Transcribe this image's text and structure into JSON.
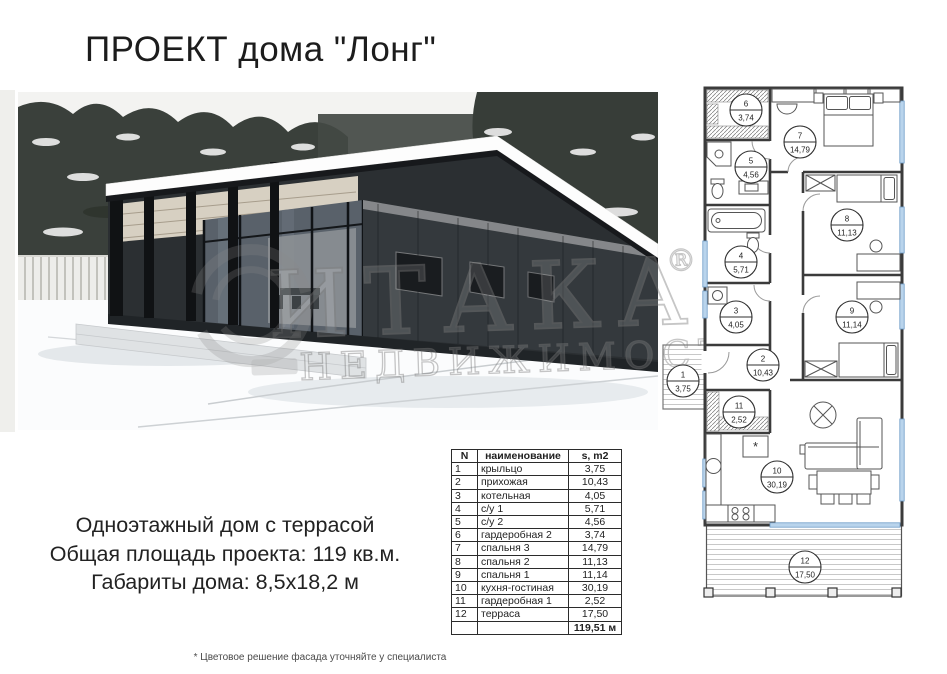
{
  "page": {
    "title": "ПРОЕКТ дома \"Лонг\"",
    "footer_note": "* Цветовое решение фасада уточняйте у специалиста"
  },
  "watermark": {
    "brand": "ИТАКА",
    "reg": "®",
    "subtitle": "НЕДВИЖИМОСТЬ"
  },
  "specs": {
    "lines": [
      "Одноэтажный дом с террасой",
      "Общая площадь проекта: 119 кв.м.",
      "Габариты дома: 8,5х18,2 м"
    ]
  },
  "table": {
    "headers": [
      "N",
      "наименование",
      "s, m2"
    ],
    "rows": [
      [
        "1",
        "крыльцо",
        "3,75"
      ],
      [
        "2",
        "прихожая",
        "10,43"
      ],
      [
        "3",
        "котельная",
        "4,05"
      ],
      [
        "4",
        "с/у 1",
        "5,71"
      ],
      [
        "5",
        "с/у 2",
        "4,56"
      ],
      [
        "6",
        "гардеробная 2",
        "3,74"
      ],
      [
        "7",
        "спальня 3",
        "14,79"
      ],
      [
        "8",
        "спальня 2",
        "11,13"
      ],
      [
        "9",
        "спальня 1",
        "11,14"
      ],
      [
        "10",
        "кухня-гостиная",
        "30,19"
      ],
      [
        "11",
        "гардеробная 1",
        "2,52"
      ],
      [
        "12",
        "терраса",
        "17,50"
      ]
    ],
    "total": "119,51 м"
  },
  "floorplan": {
    "rooms": [
      {
        "n": "1",
        "area": "3,75",
        "cx": 23,
        "cy": 296
      },
      {
        "n": "2",
        "area": "10,43",
        "cx": 103,
        "cy": 280
      },
      {
        "n": "3",
        "area": "4,05",
        "cx": 76,
        "cy": 232
      },
      {
        "n": "4",
        "area": "5,71",
        "cx": 81,
        "cy": 177
      },
      {
        "n": "5",
        "area": "4,56",
        "cx": 91,
        "cy": 82
      },
      {
        "n": "6",
        "area": "3,74",
        "cx": 86,
        "cy": 25
      },
      {
        "n": "7",
        "area": "14,79",
        "cx": 140,
        "cy": 57
      },
      {
        "n": "8",
        "area": "11,13",
        "cx": 187,
        "cy": 140
      },
      {
        "n": "9",
        "area": "11,14",
        "cx": 192,
        "cy": 232
      },
      {
        "n": "10",
        "area": "30,19",
        "cx": 117,
        "cy": 392
      },
      {
        "n": "11",
        "area": "2,52",
        "cx": 79,
        "cy": 327
      },
      {
        "n": "12",
        "area": "17,50",
        "cx": 145,
        "cy": 482
      }
    ]
  }
}
